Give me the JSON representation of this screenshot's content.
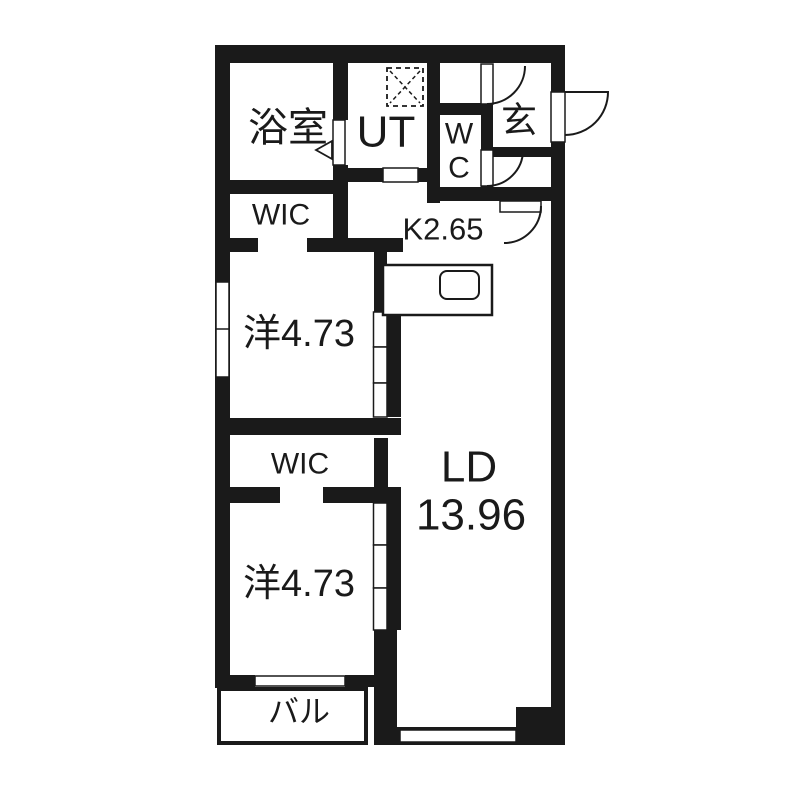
{
  "plan": {
    "type": "apartment-floor-plan",
    "rooms": {
      "bathroom": {
        "label": "浴室"
      },
      "utility": {
        "label": "UT"
      },
      "toilet": {
        "label_line1": "W",
        "label_line2": "C"
      },
      "entrance": {
        "label": "玄"
      },
      "kitchen": {
        "label": "K2.65"
      },
      "living_dining": {
        "label": "LD",
        "area": "13.96"
      },
      "wic_upper": {
        "label": "WIC"
      },
      "western_room_upper": {
        "label": "洋4.73"
      },
      "wic_lower": {
        "label": "WIC"
      },
      "western_room_lower": {
        "label": "洋4.73"
      },
      "balcony": {
        "label": "バル"
      }
    },
    "fixtures": [
      "kitchen-counter",
      "kitchen-sink",
      "washing-machine-pan",
      "entrance-door",
      "wc-door",
      "closet-door",
      "hall-door",
      "bathroom-folding-door",
      "sliding-doors",
      "windows"
    ],
    "colors": {
      "wall": "#1a1a1a",
      "floor": "#ffffff",
      "background": "#ffffff"
    }
  }
}
